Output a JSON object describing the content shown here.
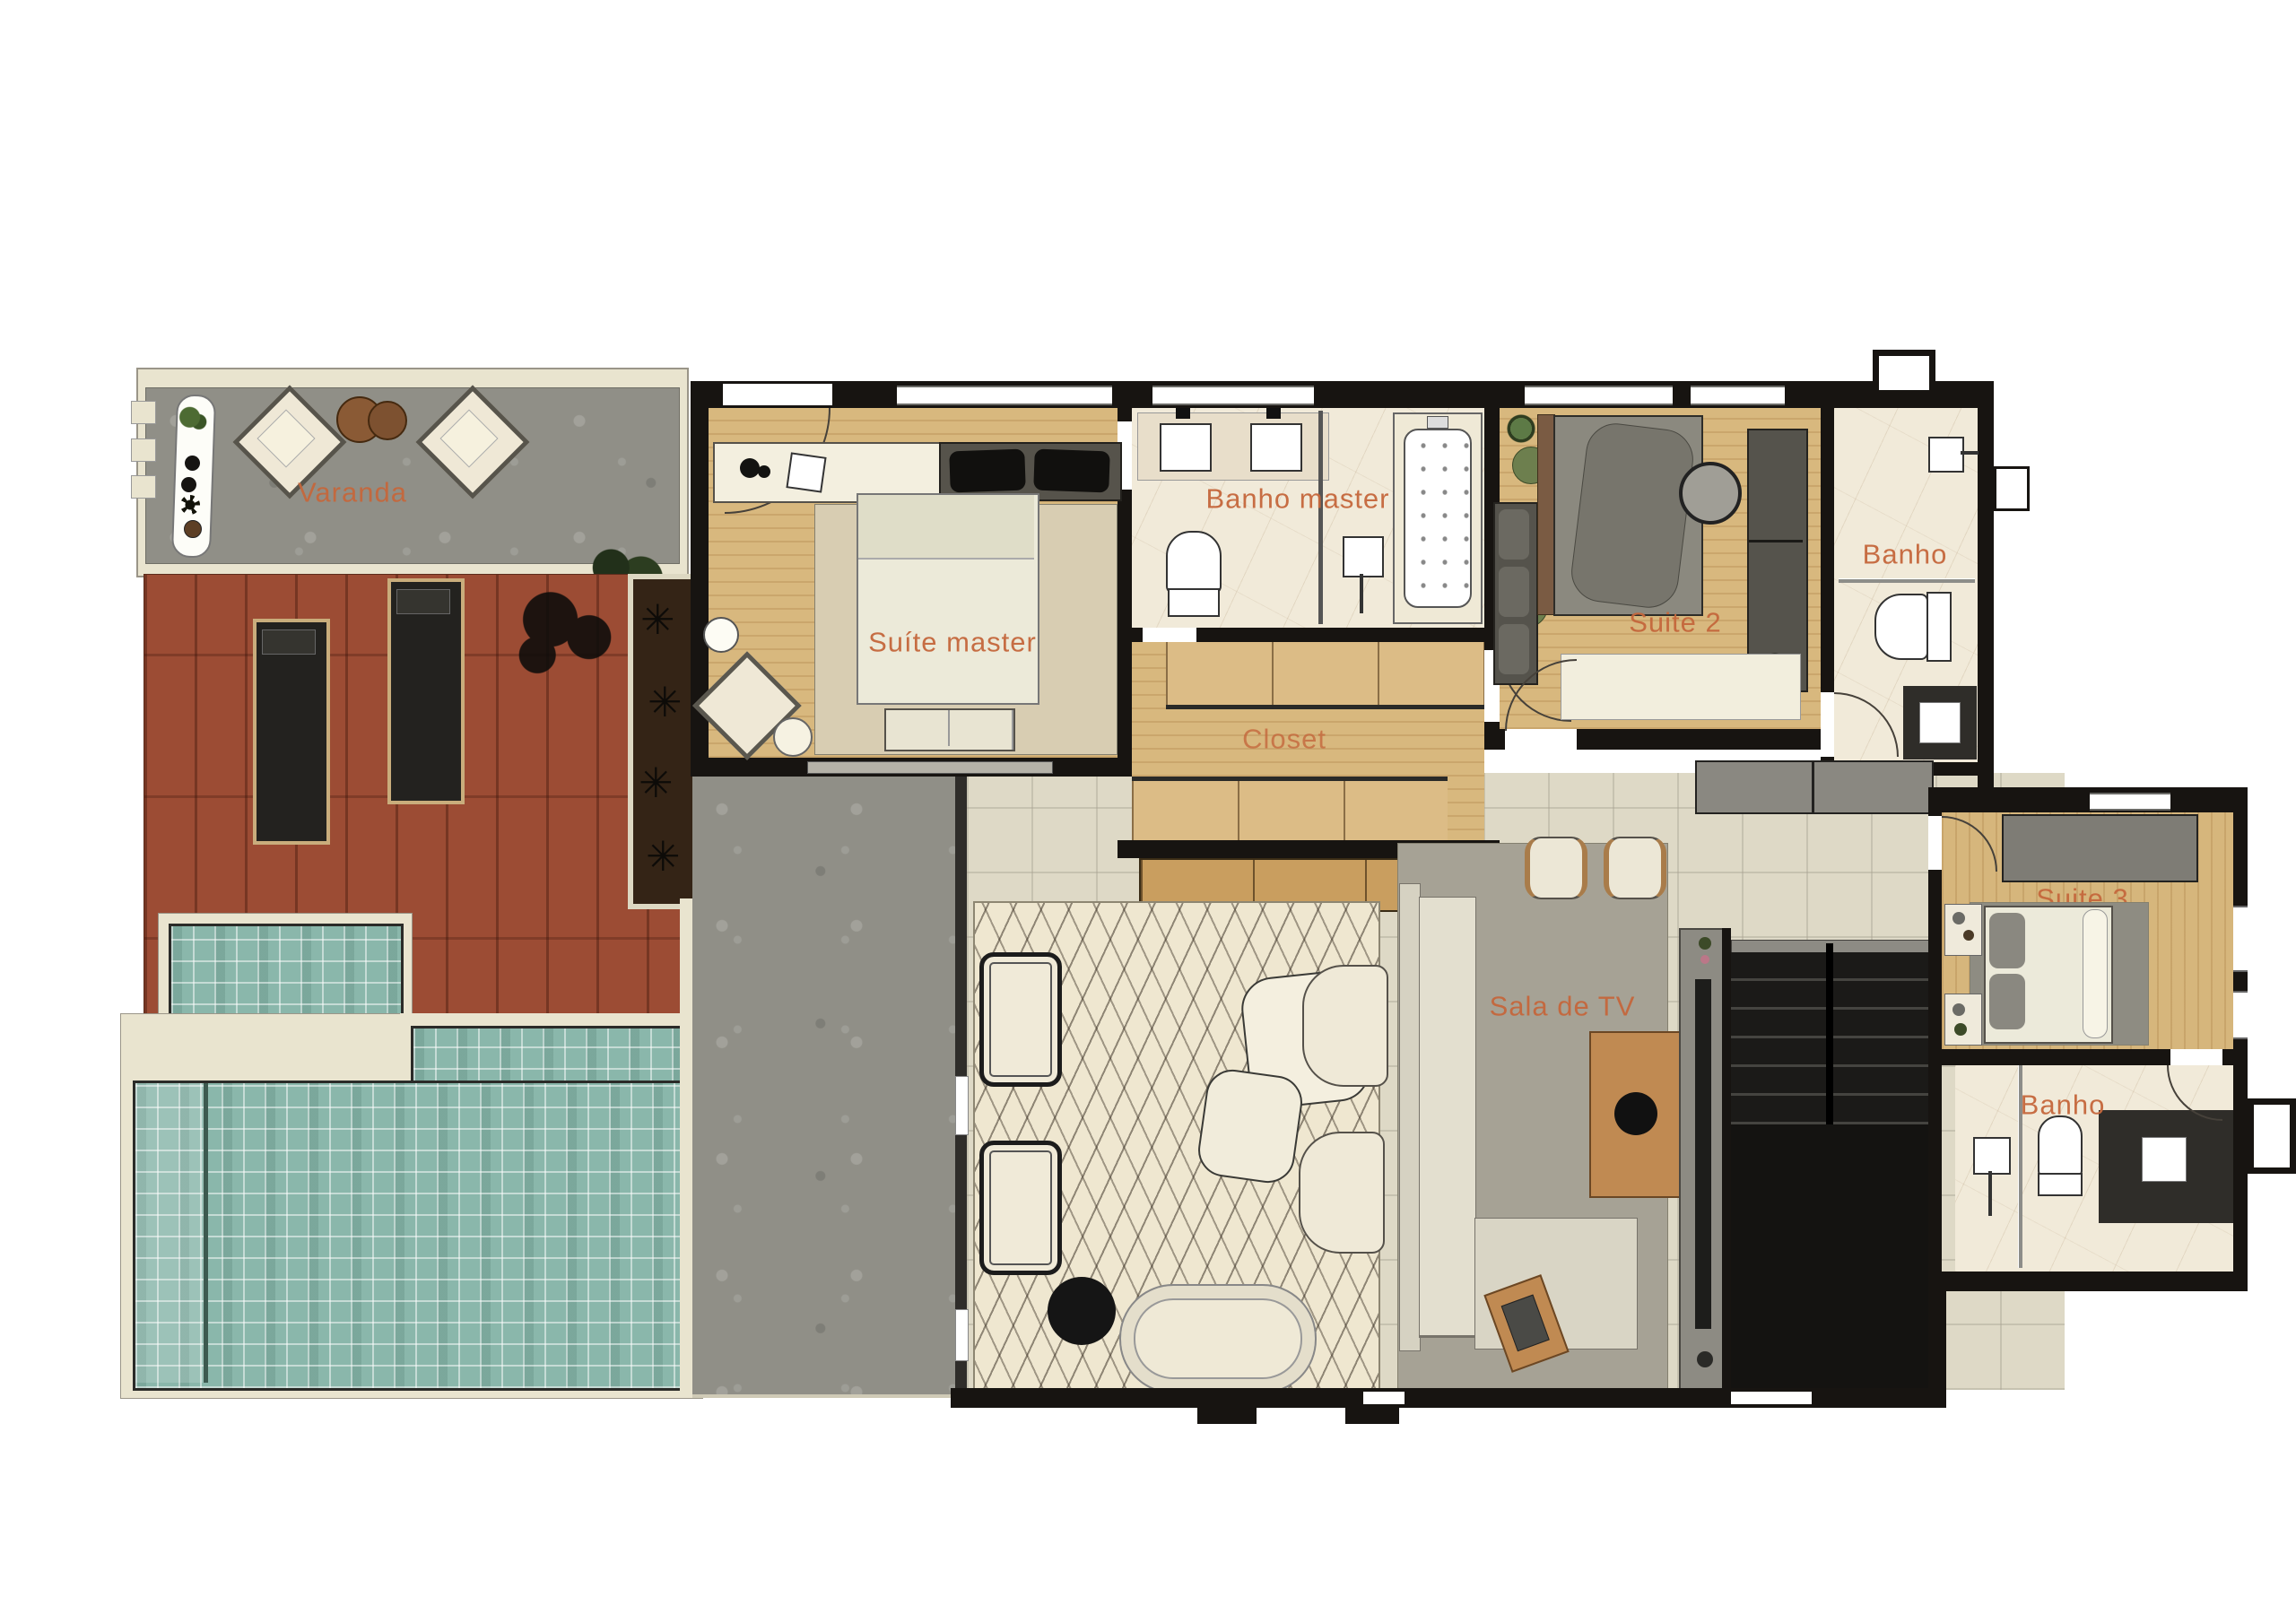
{
  "document": {
    "type": "residential floor plan",
    "language": "pt-BR"
  },
  "palette": {
    "label_orange": "#c5673c",
    "wall_black": "#171411",
    "wood_light": "#d8b87e",
    "deck_red": "#9c4c34",
    "pool_teal": "#8ab7ab",
    "stone_gray": "#908f87",
    "tile_beige": "#ded9c6",
    "marble_cream": "#f1ead9",
    "rug_gray": "#a6a295",
    "trim_cream": "#e9e4cf"
  },
  "rooms": [
    {
      "id": "varanda",
      "label": "Varanda"
    },
    {
      "id": "suite-master",
      "label": "Suíte master"
    },
    {
      "id": "banho-master",
      "label": "Banho master"
    },
    {
      "id": "closet",
      "label": "Closet"
    },
    {
      "id": "suite-2",
      "label": "Suite 2"
    },
    {
      "id": "banho-suite-2",
      "label": "Banho"
    },
    {
      "id": "sala-de-tv",
      "label": "Sala de TV"
    },
    {
      "id": "suite-3",
      "label": "Suite 3"
    },
    {
      "id": "banho-suite-3",
      "label": "Banho"
    }
  ]
}
